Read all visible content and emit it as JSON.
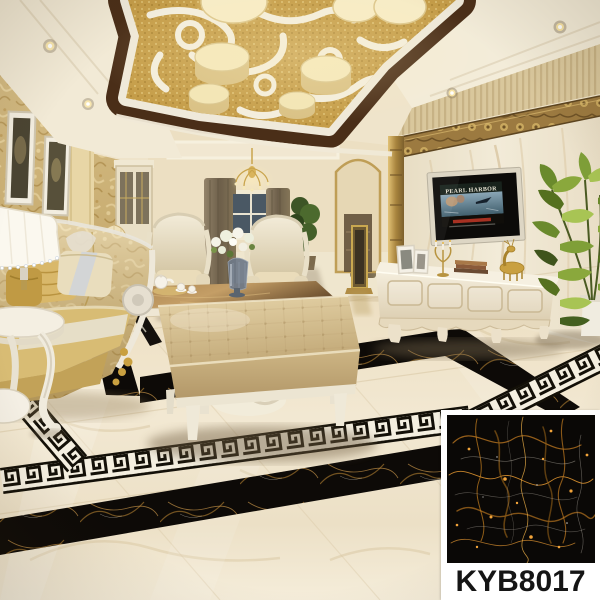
{
  "product": {
    "code": "KYB8017"
  },
  "tv": {
    "poster_title": "PEARL HARBOR"
  },
  "palette": {
    "floor_cream": "#efe4cb",
    "marble_wall": "#ece2cd",
    "ceiling_gold": "#c79f4b",
    "wood_brown": "#4a2e18",
    "sofa_gold": "#c9a84c",
    "ottoman_tan": "#d3bf92",
    "tile_black": "#0a0806",
    "vein_orange": "#e08f2e",
    "accent_white": "#ffffff",
    "plant_green": "#7f9f38",
    "curtain_taupe": "#877758",
    "greek_key_black": "#131008",
    "greek_key_white": "#f4efe0"
  }
}
